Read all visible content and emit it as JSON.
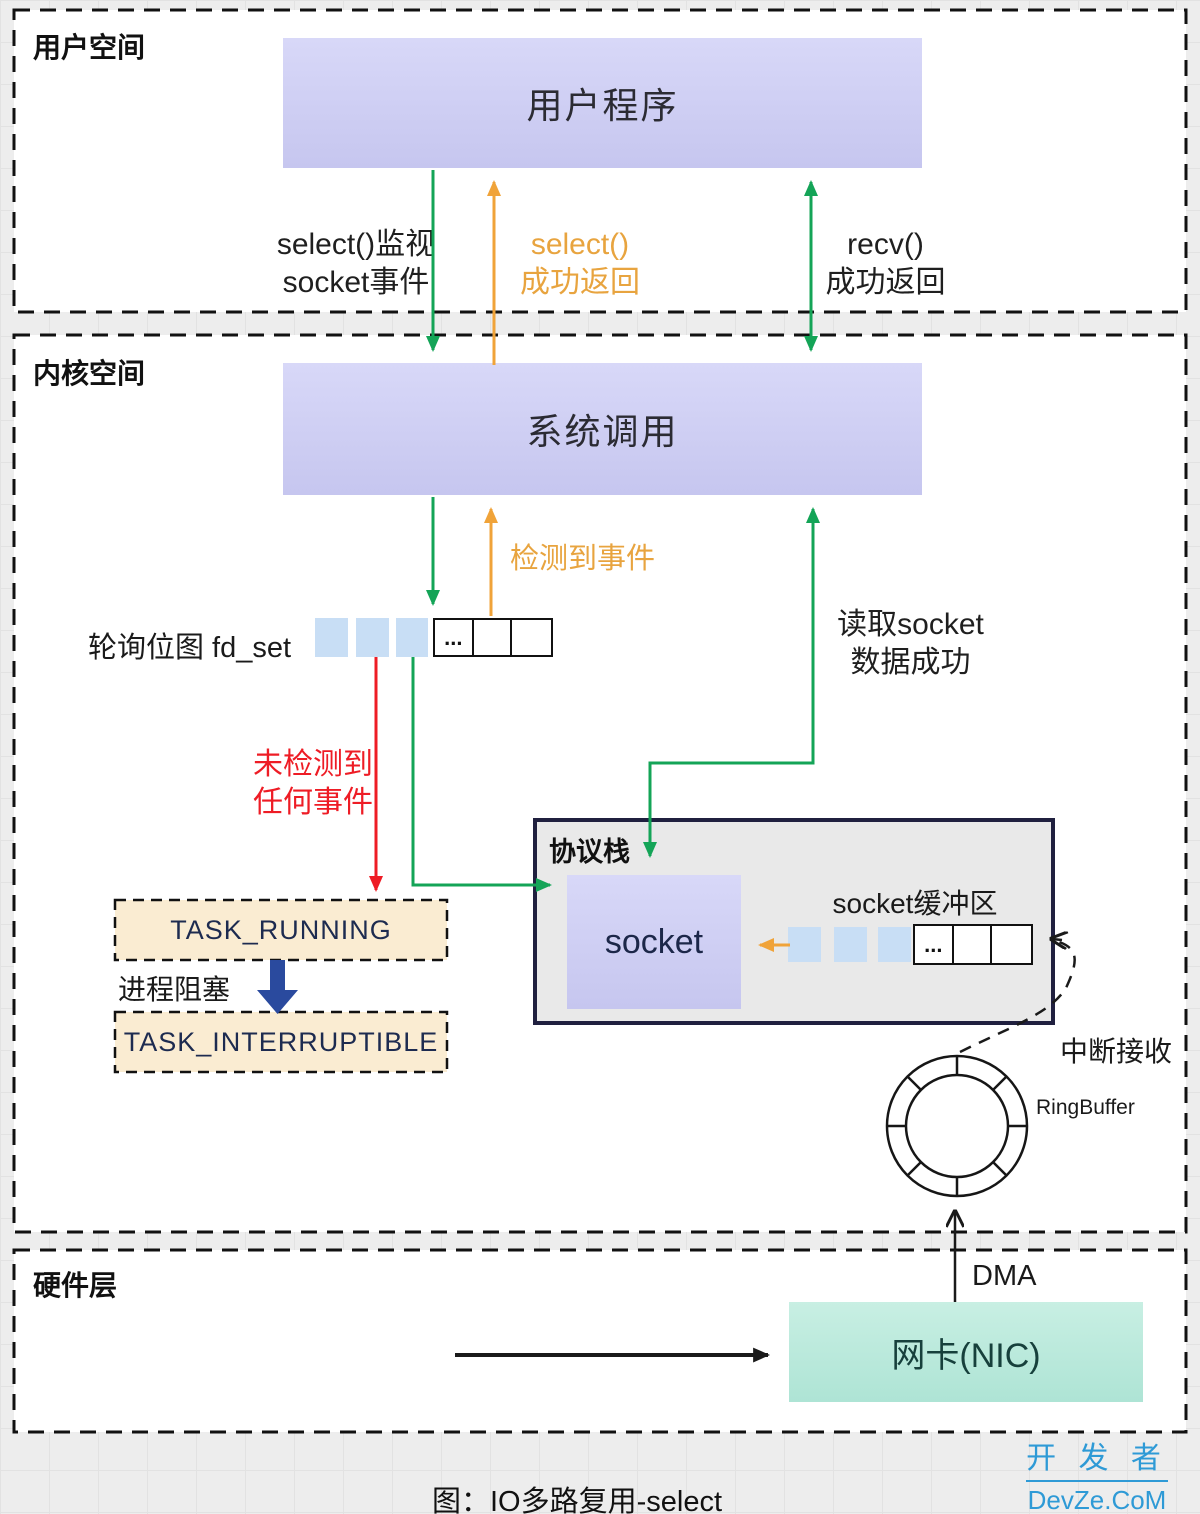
{
  "caption": "图：IO多路复用-select",
  "watermark": {
    "line1": "开 发 者",
    "line2": "DevZe.CoM"
  },
  "colors": {
    "green_arrow": "#14a457",
    "orange_arrow": "#f0a339",
    "red_arrow": "#ee1c25",
    "blue_block_arrow": "#2a4a9e",
    "purple_box": "#cbcbf1",
    "peach_box": "#faecd2",
    "mint_box": "#b5e8da",
    "panel_gray": "#e9e9e9",
    "panel_border": "#20203f",
    "watermark_blue": "#2e9ad6"
  },
  "sections": {
    "user_space": {
      "label": "用户空间"
    },
    "kernel_space": {
      "label": "内核空间"
    },
    "hardware": {
      "label": "硬件层"
    }
  },
  "nodes": {
    "user_program": "用户程序",
    "system_call": "系统调用",
    "protocol_stack": "协议栈",
    "socket": "socket",
    "nic": "网卡(NIC)",
    "task_running": "TASK_RUNNING",
    "task_interruptible": "TASK_INTERRUPTIBLE",
    "fdset_label": "轮询位图 fd_set",
    "socket_buffer_label": "socket缓冲区",
    "ringbuffer_label": "RingBuffer",
    "ellipsis": "..."
  },
  "edges": {
    "select_watch": {
      "line1": "select()监视",
      "line2": "socket事件"
    },
    "select_return": {
      "line1": "select()",
      "line2": "成功返回"
    },
    "recv_return": {
      "line1": "recv()",
      "line2": "成功返回"
    },
    "event_detected": "检测到事件",
    "read_socket": {
      "line1": "读取socket",
      "line2": "数据成功"
    },
    "no_event": {
      "line1": "未检测到",
      "line2": "任何事件"
    },
    "process_block": "进程阻塞",
    "interrupt_receive": "中断接收",
    "dma": "DMA"
  }
}
